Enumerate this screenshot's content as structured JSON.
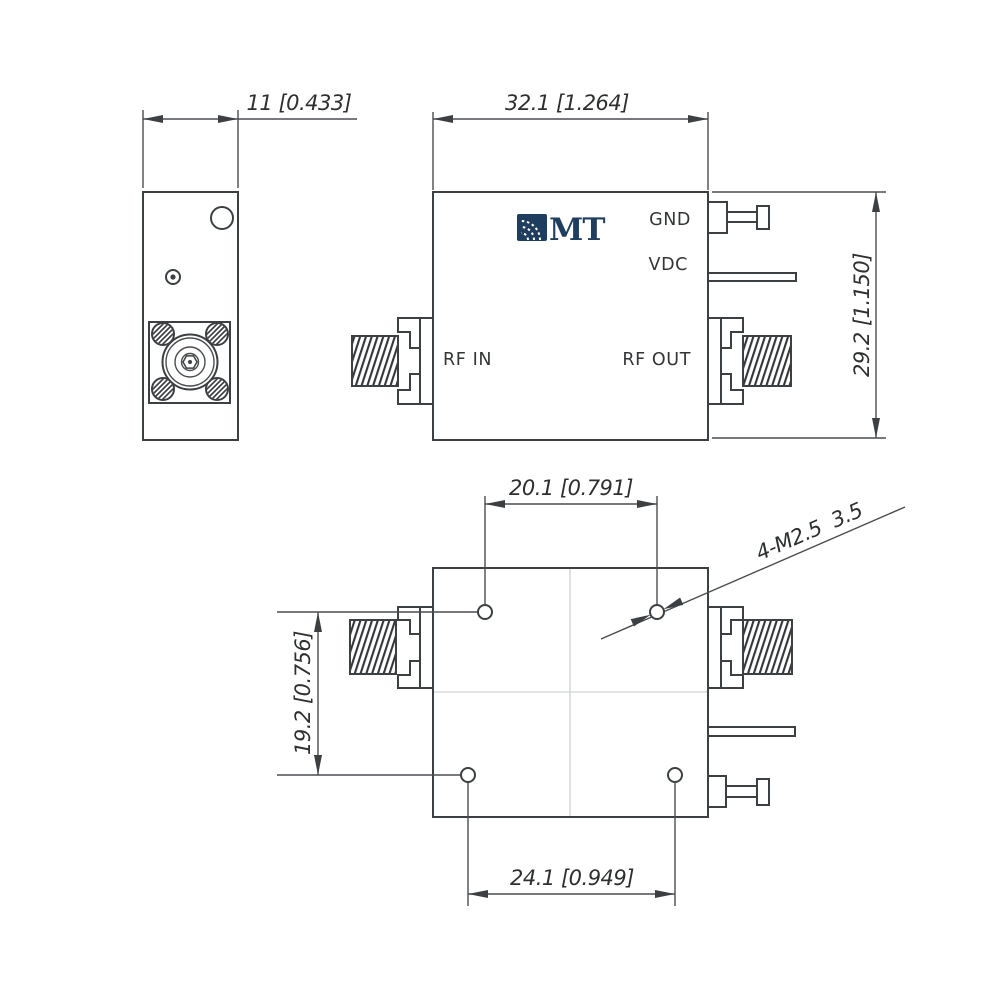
{
  "logo": {
    "text": "MT",
    "color": "#1e3d5f"
  },
  "labels": {
    "gnd": "GND",
    "vdc": "VDC",
    "rf_in": "RF IN",
    "rf_out": "RF OUT"
  },
  "dimensions": {
    "side_thickness": "11 [0.433]",
    "body_width": "32.1 [1.264]",
    "body_height": "29.2 [1.150]",
    "mount_hole_span_top": "20.1 [0.791]",
    "mount_hole_span_side": "19.2 [0.756]",
    "mount_hole_span_bottom": "24.1 [0.949]",
    "mount_hole_callout": "4-M2.5  3.5"
  },
  "colors": {
    "line": "#3c4043",
    "dimension": "#2d2f31",
    "centerline": "#cfd2d4",
    "logo_navy": "#1e3d5f",
    "background": "#ffffff"
  }
}
